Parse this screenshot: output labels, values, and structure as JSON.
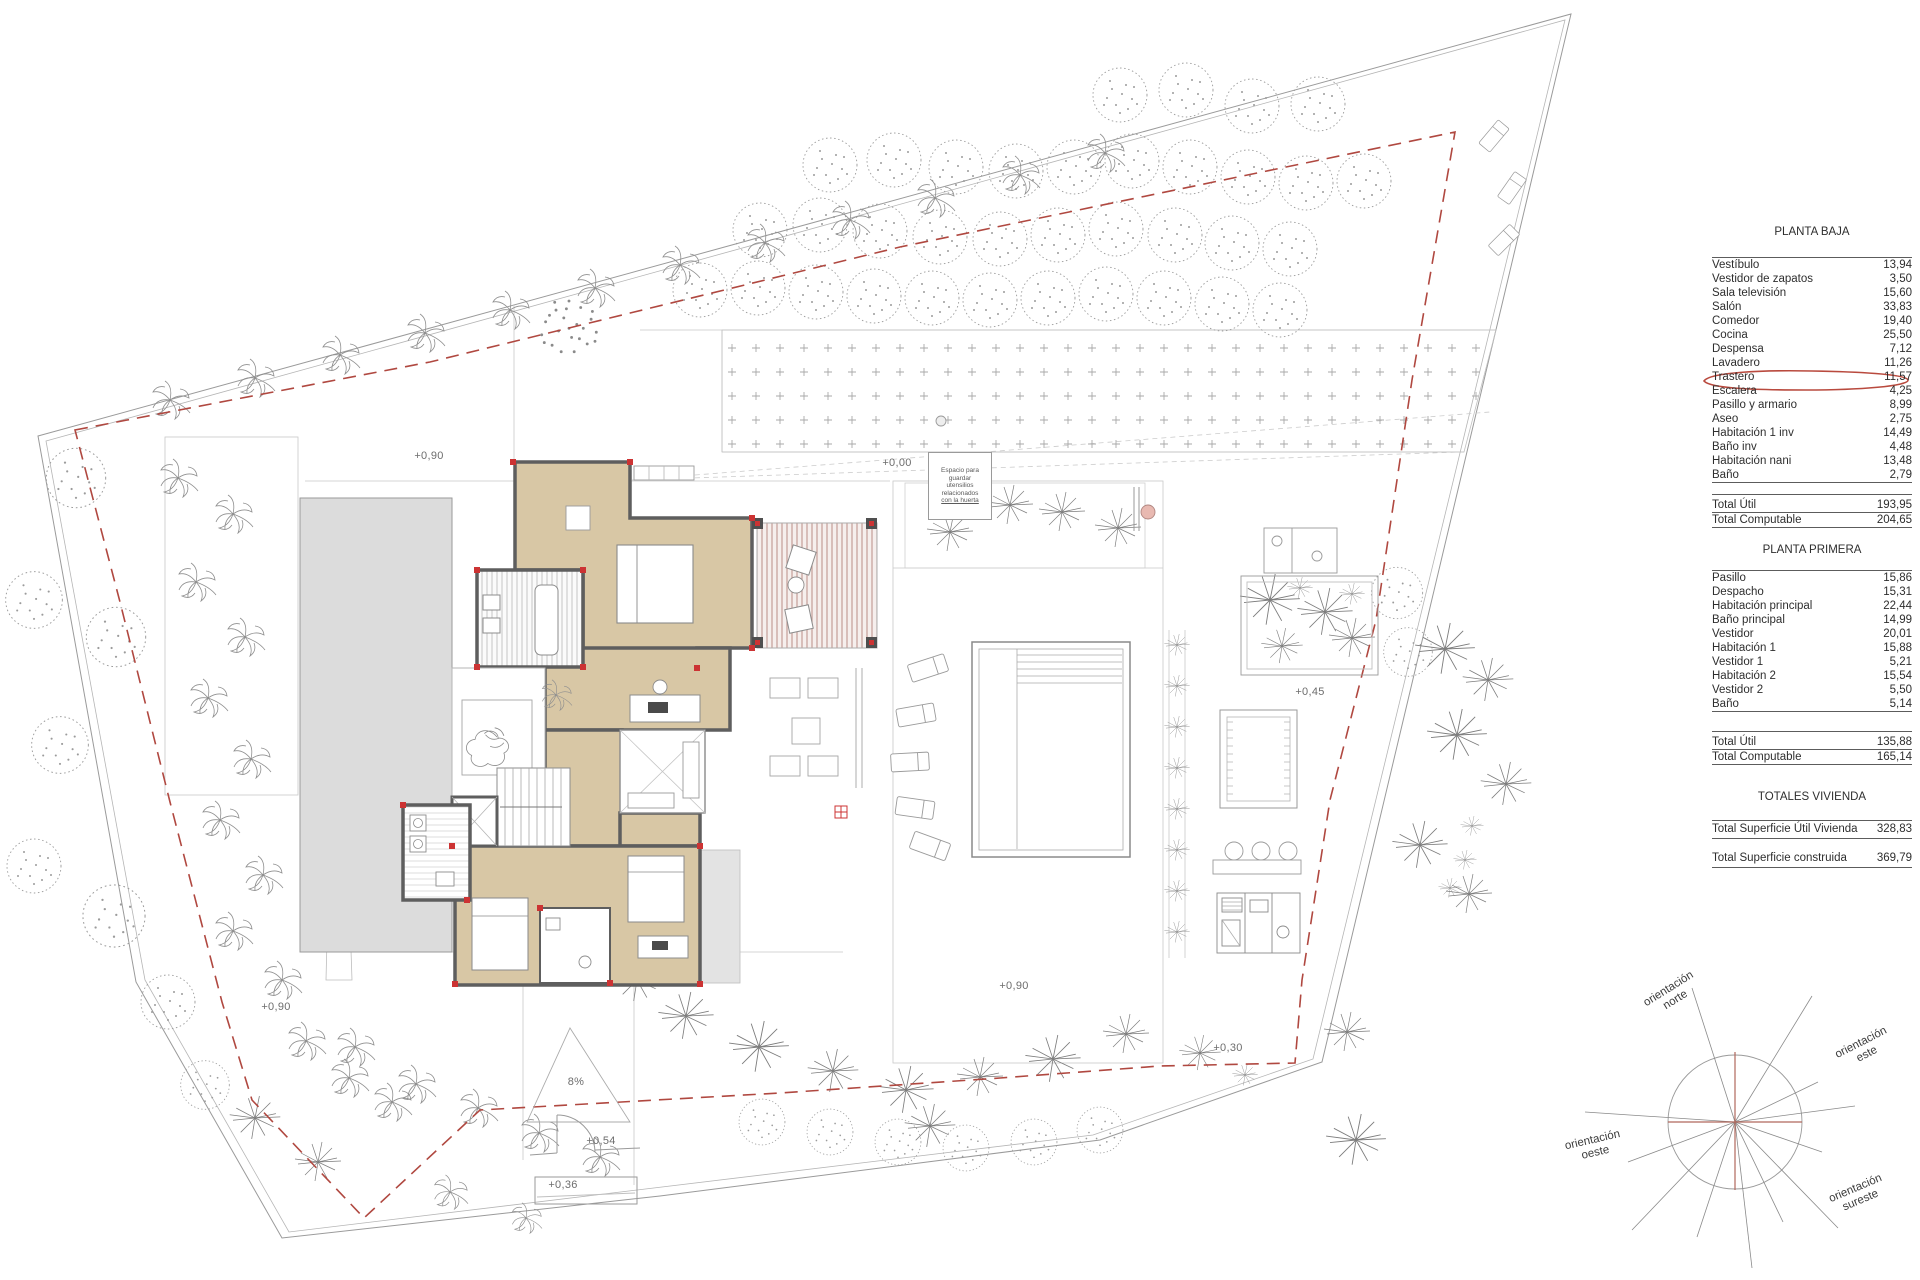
{
  "plan": {
    "levels": {
      "terrace_top": "+0,90",
      "entry": "+0,00",
      "pool_deck": "+0,90",
      "terrace_left": "+0,90",
      "garden_east": "+0,45",
      "garden_south": "+0,30",
      "gate_upper": "+0,54",
      "gate_lower": "+0,36",
      "ramp_slope": "8%"
    },
    "note_box_lines": [
      {
        "text": "Espacio para"
      },
      {
        "text": "guardar"
      },
      {
        "text": "utensilios"
      },
      {
        "text": "relacionados"
      },
      {
        "text": "con la huerta"
      }
    ]
  },
  "tables": {
    "planta_baja": {
      "title": "PLANTA BAJA",
      "rows": [
        {
          "label": "Vestíbulo",
          "value": "13,94"
        },
        {
          "label": "Vestidor de zapatos",
          "value": "3,50"
        },
        {
          "label": "Sala televisión",
          "value": "15,60"
        },
        {
          "label": "Salón",
          "value": "33,83"
        },
        {
          "label": "Comedor",
          "value": "19,40"
        },
        {
          "label": "Cocina",
          "value": "25,50"
        },
        {
          "label": "Despensa",
          "value": "7,12"
        },
        {
          "label": "Lavadero",
          "value": "11,26"
        },
        {
          "label": "Trastero",
          "value": "11,57"
        },
        {
          "label": "Escalera",
          "value": "4,25"
        },
        {
          "label": "Pasillo y armario",
          "value": "8,99"
        },
        {
          "label": "Aseo",
          "value": "2,75"
        },
        {
          "label": "Habitación 1 inv",
          "value": "14,49"
        },
        {
          "label": "Baño inv",
          "value": "4,48"
        },
        {
          "label": "Habitación nani",
          "value": "13,48"
        },
        {
          "label": "Baño",
          "value": "2,79"
        }
      ],
      "totals": [
        {
          "label": "Total Útil",
          "value": "193,95"
        },
        {
          "label": "Total Computable",
          "value": "204,65"
        }
      ],
      "highlighted_row": "Trastero"
    },
    "planta_primera": {
      "title": "PLANTA PRIMERA",
      "rows": [
        {
          "label": "Pasillo",
          "value": "15,86"
        },
        {
          "label": "Despacho",
          "value": "15,31"
        },
        {
          "label": "Habitación principal",
          "value": "22,44"
        },
        {
          "label": "Baño principal",
          "value": "14,99"
        },
        {
          "label": "Vestidor",
          "value": "20,01"
        },
        {
          "label": "Habitación 1",
          "value": "15,88"
        },
        {
          "label": "Vestidor 1",
          "value": "5,21"
        },
        {
          "label": "Habitación 2",
          "value": "15,54"
        },
        {
          "label": "Vestidor 2",
          "value": "5,50"
        },
        {
          "label": "Baño",
          "value": "5,14"
        }
      ],
      "totals": [
        {
          "label": "Total Útil",
          "value": "135,88"
        },
        {
          "label": "Total Computable",
          "value": "165,14"
        }
      ]
    },
    "totales": {
      "title": "TOTALES VIVIENDA",
      "rows": [
        {
          "label": "Total Superficie Útil Vivienda",
          "value": "328,83"
        },
        {
          "label": "Total Superficie construida",
          "value": "369,79"
        }
      ]
    }
  },
  "compass": {
    "norte": {
      "l1": "orientación",
      "l2": "norte"
    },
    "este": {
      "l1": "orientación",
      "l2": "este"
    },
    "oeste": {
      "l1": "orientación",
      "l2": "oeste"
    },
    "sureste": {
      "l1": "orientación",
      "l2": "sureste"
    }
  },
  "colors": {
    "setback_red": "#b04840",
    "highlight_red": "#b94a3e",
    "wall_gray": "#5e5e5e",
    "floor_beige": "#d8c7a5",
    "slab_gray": "#dcdcdc",
    "terrace_pink": "#c59d97"
  }
}
